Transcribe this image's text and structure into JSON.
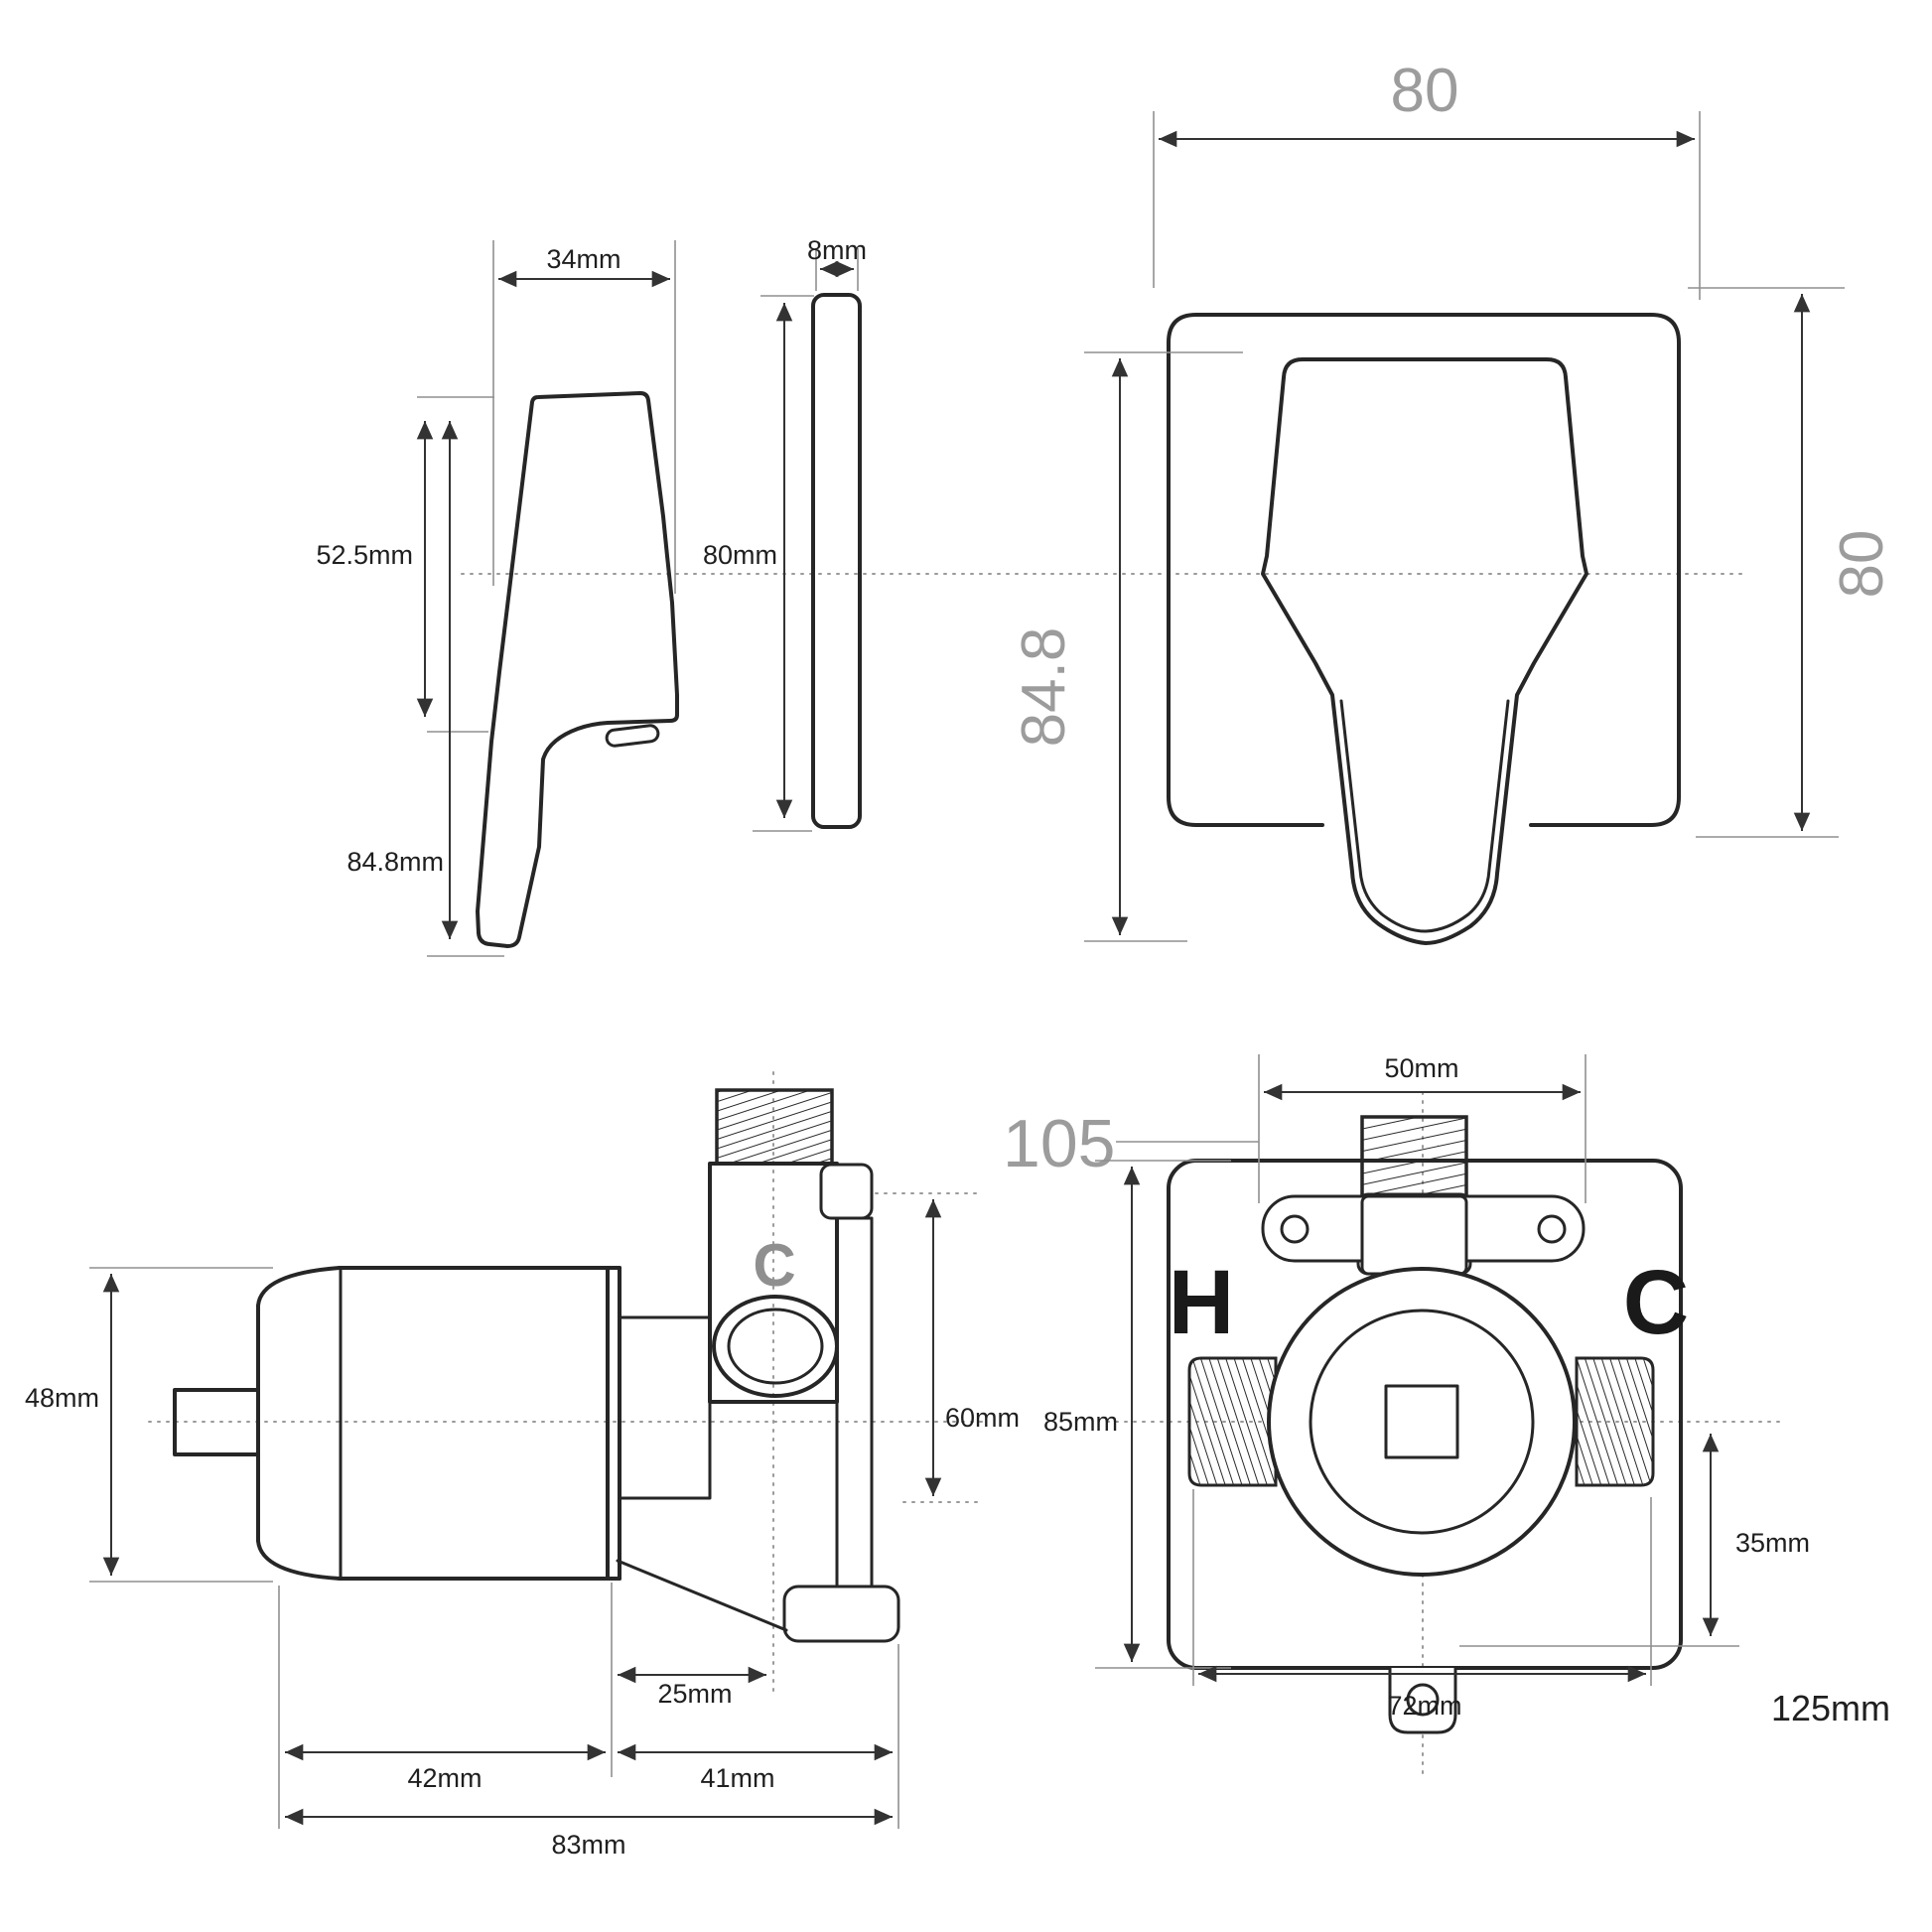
{
  "title": "Shower mixer valve dimensional drawing",
  "colors": {
    "line": "#262626",
    "dim": "#333333",
    "muted": "#8f8f8f",
    "gray_text": "#9c9c9c",
    "background": "#ffffff"
  },
  "views": {
    "handle_side": {
      "width": "34mm",
      "upper_height": "52.5mm",
      "total_height": "84.8mm"
    },
    "plate_side": {
      "thickness": "8mm",
      "height": "80mm"
    },
    "trim_front": {
      "width": "80",
      "height": "80",
      "handle_height": "84.8"
    },
    "valve_side": {
      "diameter": "48mm",
      "outlet": "C",
      "height": "60mm",
      "outlet_offset": "25mm",
      "cartridge_length": "42mm",
      "body_length": "41mm",
      "total_length": "83mm"
    },
    "valve_front": {
      "overall_height": "105",
      "thread_span": "50mm",
      "plate_height": "85mm",
      "hot": "H",
      "cold": "C",
      "lower_offset": "35mm",
      "plate_width": "72mm",
      "overall_width": "125mm"
    }
  }
}
